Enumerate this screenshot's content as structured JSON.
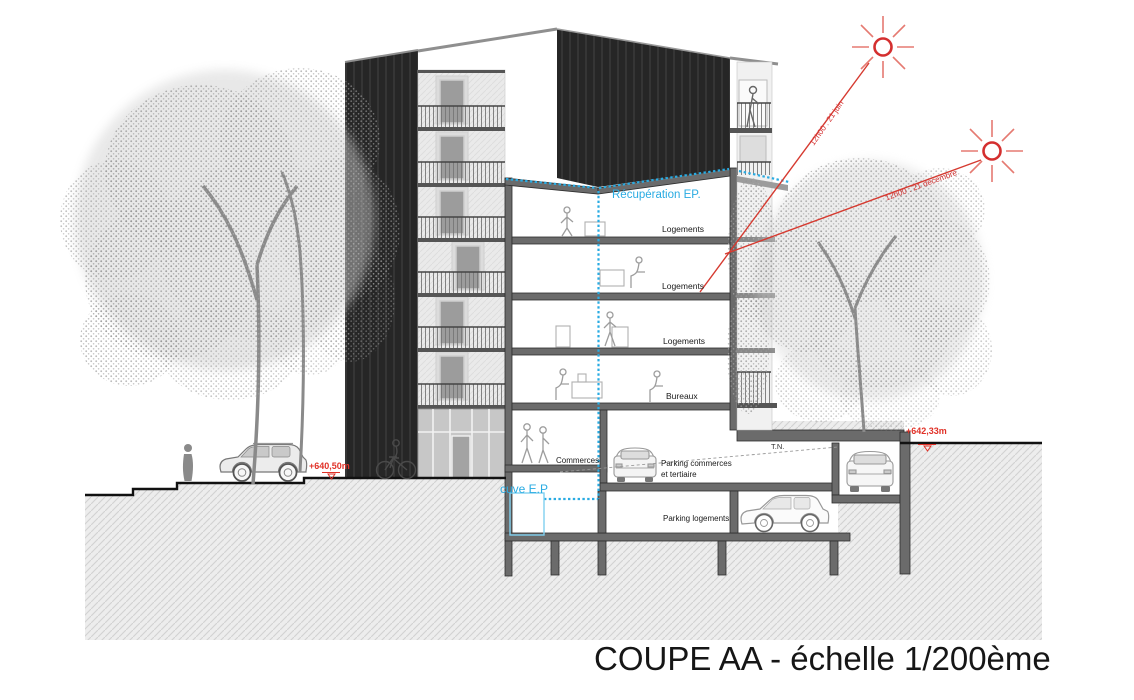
{
  "drawing": {
    "title": "COUPE AA - échelle 1/200ème",
    "floor_labels": {
      "logements_top": "Logements",
      "logements_mid": "Logements",
      "logements_low": "Logements",
      "bureaux": "Bureaux",
      "commerces": "Commerces",
      "parking_commerces": "Parking commerces et tertiaire",
      "parking_logements": "Parking logements"
    },
    "water": {
      "recuperation": "Récupération EP.",
      "cuve": "cuve E.P"
    },
    "sun": {
      "june": "12h00 : 21 juin",
      "december": "12h00 : 21 décembre"
    },
    "levels": {
      "street": "+640,50m",
      "upper": "+642,33m",
      "terrain": "T.N."
    },
    "colors": {
      "annotation_red": "#e03127",
      "annotation_blue": "#29abe2",
      "facade_black": "#262626",
      "ink": "#1a1a1a"
    }
  }
}
